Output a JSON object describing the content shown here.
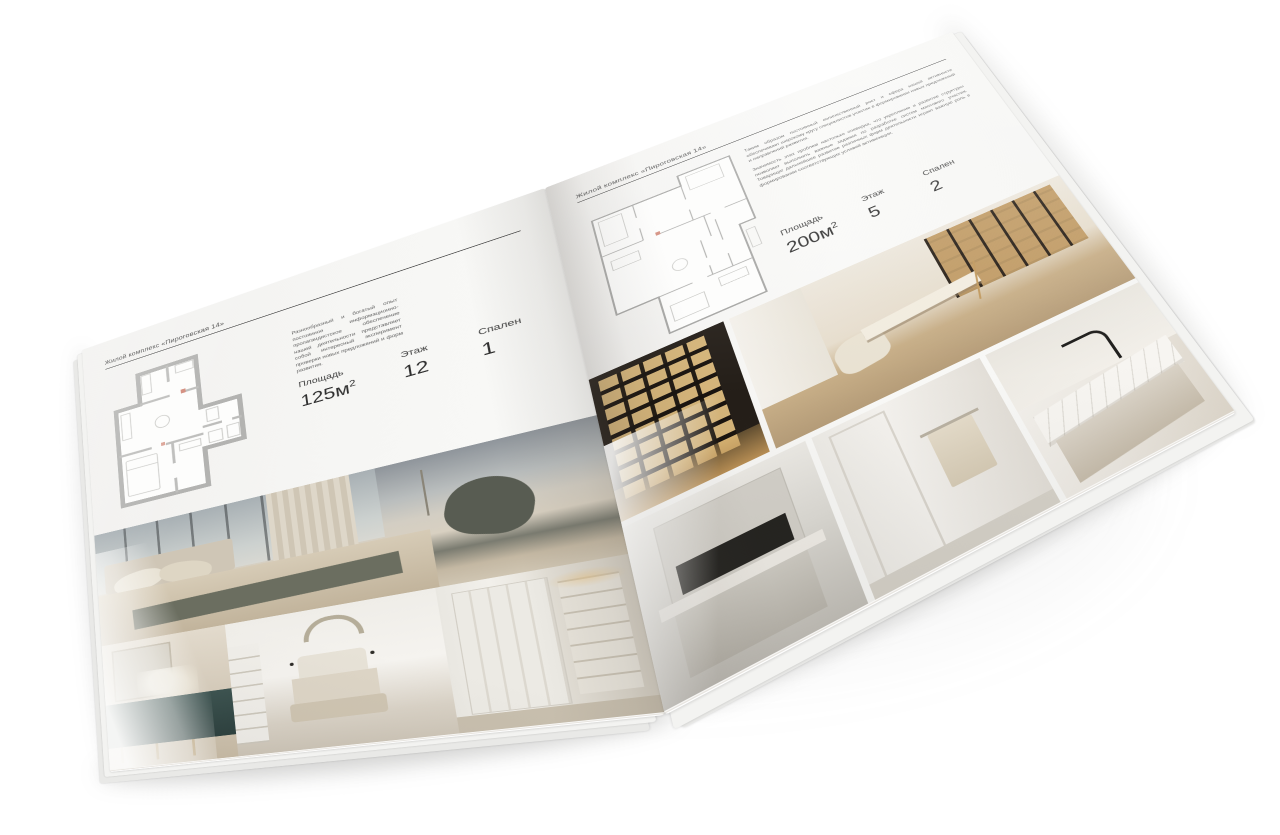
{
  "canvas": {
    "background": "#ffffff"
  },
  "magazine": {
    "left_page": {
      "header": "Жилой комплекс «Пироговская 14»",
      "description": "Разнообразный и богатый опыт постоянное информационно-пропагандистское обеспечение нашей деятельности представляет собой интересный эксперимент проверки новых предложений и форм развития.",
      "specs": [
        {
          "label": "Площадь",
          "value": "125м",
          "sup": "2"
        },
        {
          "label": "Этаж",
          "value": "12",
          "sup": ""
        },
        {
          "label": "Спален",
          "value": "1",
          "sup": ""
        }
      ],
      "photos": [
        "bedroom-panorama",
        "dresser-detail",
        "white-bedroom",
        "wardrobe-hall"
      ]
    },
    "right_page": {
      "header": "Жилой комплекс «Пироговская 14»",
      "paragraphs": [
        "Таким образом постоянный количественный рост и сфера нашей активности обеспечивает широкому кругу специалистов участие в формировании новых предложений и направлений развития.",
        "Значимость этих проблем настолько очевидна, что укрепление и развитие структуры позволяет выполнять важные задания по разработке систем массового участия. Товарищи! дальнейшее развитие различных форм деятельности играет важную роль в формировании соответствующих условий активизации."
      ],
      "specs": [
        {
          "label": "Площадь",
          "value": "200м",
          "sup": "2"
        },
        {
          "label": "Этаж",
          "value": "5",
          "sup": ""
        },
        {
          "label": "Спален",
          "value": "2",
          "sup": ""
        }
      ],
      "photos": [
        "display-cabinet",
        "study-library",
        "kitchen-detail",
        "bathroom-towel",
        "marble-washbasin"
      ]
    },
    "colors": {
      "paper": "#f6f6f4",
      "rule": "#3c3c3c",
      "text": "#4a4a4a",
      "fine_print": "#5a5a5a"
    }
  }
}
